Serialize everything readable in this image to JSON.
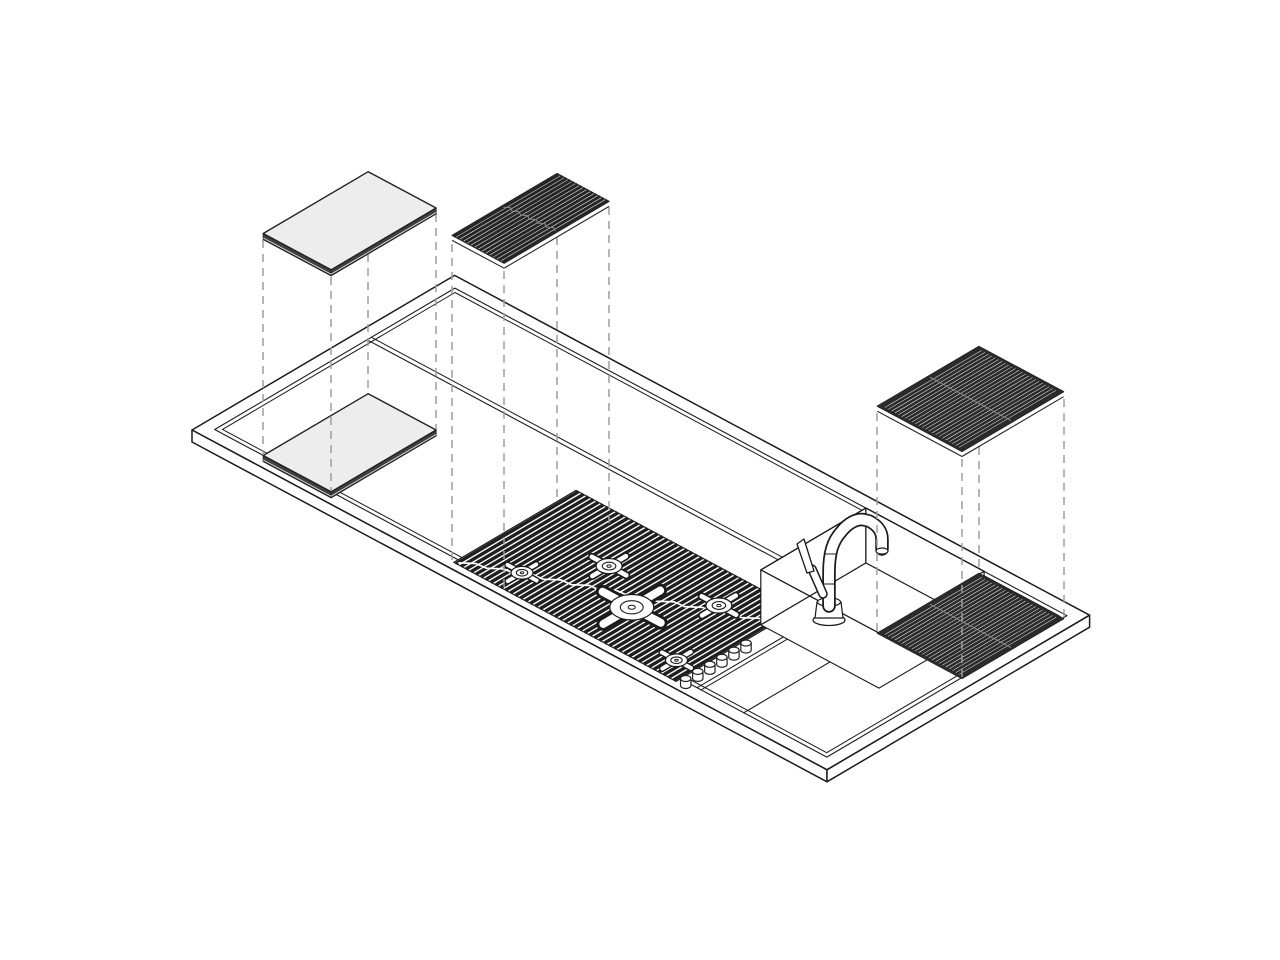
{
  "canvas": {
    "width": 1280,
    "height": 960,
    "background": "#ffffff"
  },
  "iso": {
    "origin": [
      192,
      430
    ],
    "u": [
      0.882,
      0.472
    ],
    "v": [
      0.861,
      -0.507
    ]
  },
  "style": {
    "stroke": "#1b1b1b",
    "dash_color": "#9e9e9e",
    "dash_pattern": "8 6",
    "white": "#ffffff",
    "board_top": "#ededed",
    "board_side": "#3f3f3f",
    "grid_dark": "#2b2b2b",
    "slat_dark": "#1f1f1f",
    "seam_light": "#8a8a8a"
  },
  "components": {
    "worktop": "stainless worktop slab with recessed tray",
    "back_channel": "accessory sliding channel along back edge",
    "cutting_board": "sliding board (resting + floating exploded copy)",
    "cooktop": "slatted grill cooktop with 5 burner supports and 6 control knobs",
    "trivet": "floating slatted grill trivet over cooktop",
    "sink": "recessed sink basin with mixer faucet",
    "drying_grid": "dark slatted drying grid right of sink (resting + floating exploded copy)"
  },
  "elements": [
    {
      "n": "worktop-slab-top",
      "t": "poly",
      "p": [
        [
          0,
          0
        ],
        [
          0,
          305
        ],
        [
          720,
          305
        ],
        [
          720,
          0
        ]
      ],
      "dy": 0,
      "f": "#ffffff",
      "s": "#1b1b1b",
      "w": 1.5
    },
    {
      "n": "worktop-front-face",
      "t": "vwall",
      "p": [
        [
          0,
          0
        ],
        [
          720,
          0
        ]
      ],
      "h": 12,
      "f": "#ffffff",
      "s": "#1b1b1b",
      "w": 1.5
    },
    {
      "n": "worktop-right-face",
      "t": "vwall",
      "p": [
        [
          720,
          0
        ],
        [
          720,
          305
        ]
      ],
      "h": 12,
      "f": "#ffffff",
      "s": "#1b1b1b",
      "w": 1.5
    },
    {
      "n": "tray-rim-outer",
      "t": "poly",
      "p": [
        [
          13,
          13
        ],
        [
          13,
          292
        ],
        [
          707,
          292
        ],
        [
          707,
          13
        ]
      ],
      "dy": 0,
      "f": "none",
      "s": "#1b1b1b",
      "w": 1.1
    },
    {
      "n": "tray-rim-inner",
      "t": "poly",
      "p": [
        [
          17.5,
          17.5
        ],
        [
          17.5,
          287.5
        ],
        [
          702.5,
          287.5
        ],
        [
          702.5,
          17.5
        ]
      ],
      "dy": 0,
      "f": "none",
      "s": "#1b1b1b",
      "w": 1
    },
    {
      "n": "back-channel-line-1",
      "t": "line",
      "p": [
        [
          13,
          190
        ],
        [
          479,
          190
        ]
      ],
      "dy": 0,
      "s": "#1b1b1b",
      "w": 1.1
    },
    {
      "n": "back-channel-line-2",
      "t": "line",
      "p": [
        [
          13,
          195
        ],
        [
          479,
          195
        ]
      ],
      "dy": 0,
      "s": "#1b1b1b",
      "w": 1
    },
    {
      "n": "cooktop-border",
      "t": "poly",
      "p": [
        [
          289,
          8
        ],
        [
          289,
          150
        ],
        [
          541,
          150
        ],
        [
          541,
          8
        ]
      ],
      "dy": 0,
      "f": "#ffffff",
      "s": "#1f1f1f",
      "w": 1.2
    },
    {
      "n": 45,
      "t": "slats",
      "a0": 289,
      "a1": 541,
      "b0": 8,
      "b1": 150,
      "dy": 0,
      "s": "#1f1f1f",
      "w": 3.4
    },
    {
      "n": "cooktop-seam",
      "t": "wavy",
      "a0": 292,
      "a1": 538,
      "b0": 12,
      "b1": 122,
      "amp": 2,
      "seg": 22,
      "dy": 0,
      "s": "#ffffff",
      "w": 1.7
    },
    {
      "n": "burner-1",
      "t": "burner",
      "a": 340,
      "b": 35,
      "r": 11
    },
    {
      "n": "burner-2",
      "t": "burner",
      "a": 385,
      "b": 90,
      "r": 13
    },
    {
      "n": "burner-3",
      "t": "burner",
      "a": 440,
      "b": 60,
      "r": 22
    },
    {
      "n": "burner-4",
      "t": "burner",
      "a": 490,
      "b": 110,
      "r": 13
    },
    {
      "n": "burner-5",
      "t": "burner",
      "a": 520,
      "b": 30,
      "r": 11
    },
    {
      "n": "apron-line-1",
      "t": "line",
      "p": [
        [
          560,
          13
        ],
        [
          560,
          170
        ]
      ],
      "dy": 0,
      "s": "#1b1b1b",
      "w": 1.1
    },
    {
      "n": "apron-line-2",
      "t": "line",
      "p": [
        [
          564.5,
          13
        ],
        [
          564.5,
          170
        ]
      ],
      "dy": 0,
      "s": "#1b1b1b",
      "w": 1
    },
    {
      "n": "section-divider",
      "t": "line",
      "p": [
        [
          613,
          13
        ],
        [
          613,
          170
        ]
      ],
      "dy": 0,
      "s": "#1b1b1b",
      "w": 1.1
    },
    {
      "n": "knob-1",
      "t": "knob",
      "a": 551,
      "b": 9
    },
    {
      "n": "knob-2",
      "t": "knob",
      "a": 551,
      "b": 23
    },
    {
      "n": "knob-3",
      "t": "knob",
      "a": 551,
      "b": 37
    },
    {
      "n": "knob-4",
      "t": "knob",
      "a": 551,
      "b": 51
    },
    {
      "n": "knob-5",
      "t": "knob",
      "a": 551,
      "b": 65
    },
    {
      "n": "knob-6",
      "t": "knob",
      "a": 551,
      "b": 79
    },
    {
      "n": "sink-west-wall",
      "t": "vwall",
      "p": [
        [
          479,
          170
        ],
        [
          479,
          292
        ]
      ],
      "h": 55,
      "f": "#ffffff",
      "s": "#1b1b1b",
      "w": 1.2
    },
    {
      "n": "sink-back-wall",
      "t": "vwall",
      "p": [
        [
          479,
          292
        ],
        [
          613,
          292
        ]
      ],
      "h": 55,
      "f": "#ffffff",
      "s": "#1b1b1b",
      "w": 1.2
    },
    {
      "n": "sink-floor",
      "t": "poly",
      "p": [
        [
          479,
          170
        ],
        [
          479,
          292
        ],
        [
          613,
          292
        ],
        [
          613,
          170
        ]
      ],
      "dy": 55,
      "f": "#ffffff",
      "s": "#1b1b1b",
      "w": 1.1
    },
    {
      "n": "sink-rim",
      "t": "poly",
      "p": [
        [
          479,
          170
        ],
        [
          479,
          292
        ],
        [
          613,
          292
        ],
        [
          613,
          170
        ]
      ],
      "dy": 0,
      "f": "none",
      "s": "#1b1b1b",
      "w": 1.3
    },
    {
      "n": "faucet-base-flange",
      "t": "sellipse",
      "cx": 829,
      "cy": 620,
      "rx": 16,
      "ry": 5.5,
      "f": "#ffffff",
      "s": "#1b1b1b",
      "w": 1.3
    },
    {
      "n": "faucet-base-cup",
      "t": "spath",
      "d": "M817,602 L841,602 L843,618 L815,618 Z",
      "f": "#ffffff",
      "s": "#1b1b1b",
      "w": 1.2
    },
    {
      "n": "faucet-base-top",
      "t": "sellipse",
      "cx": 829,
      "cy": 602,
      "rx": 11.5,
      "ry": 4.2,
      "f": "#ffffff",
      "s": "#1b1b1b",
      "w": 1.2
    },
    {
      "n": "faucet-riser-outline",
      "t": "spath",
      "d": "M829,606 L829,573 C829,552 833,541 841,532 C848,523 857,518 865,520 L869,521 C877,525 882,531 882,539 L882,549",
      "f": "none",
      "s": "#1b1b1b",
      "w": 13.5,
      "cap": "round"
    },
    {
      "n": "faucet-riser-fill",
      "t": "spath",
      "d": "M829,606 L829,573 C829,552 833,541 841,532 C848,523 857,518 865,520 L869,521 C877,525 882,531 882,539 L882,549",
      "f": "none",
      "s": "#ffffff",
      "w": 10,
      "cap": "round"
    },
    {
      "n": "faucet-joint-1",
      "t": "spath",
      "d": "M822.5,584 L835.5,584",
      "f": "none",
      "s": "#1b1b1b",
      "w": 1
    },
    {
      "n": "faucet-joint-2",
      "t": "spath",
      "d": "M824,554 L837,554",
      "f": "none",
      "s": "#1b1b1b",
      "w": 1
    },
    {
      "n": "faucet-spout-tip",
      "t": "sellipse",
      "cx": 882,
      "cy": 551,
      "rx": 6,
      "ry": 3,
      "f": "#ffffff",
      "s": "#1b1b1b",
      "w": 1.2
    },
    {
      "n": "faucet-handle-outline",
      "t": "spath",
      "d": "M823,594 L812,569",
      "f": "none",
      "s": "#1b1b1b",
      "w": 9.5,
      "cap": "round"
    },
    {
      "n": "faucet-handle-fill",
      "t": "spath",
      "d": "M823,594 L812,569",
      "f": "none",
      "s": "#ffffff",
      "w": 6.5,
      "cap": "round"
    },
    {
      "n": "faucet-handle-blade",
      "t": "spath",
      "d": "M814,571 L804,539 L797,544 L807,573 Z",
      "f": "#ffffff",
      "s": "#1b1b1b",
      "w": 1.3
    },
    {
      "n": "resting-board",
      "t": "prism",
      "a0": 68,
      "a1": 145,
      "b0": 13,
      "b1": 135,
      "dy": 0,
      "h": 6,
      "top": "#ededed",
      "side": "#3f3f3f",
      "s": "#222222"
    },
    {
      "n": "resting-drying-grid",
      "t": "grate",
      "a0": 612,
      "a1": 708,
      "b0": 169,
      "b1": 287,
      "dy": 0,
      "rails": 0
    },
    {
      "n": "projection-dash",
      "t": "dash",
      "x": 263,
      "y0": 240,
      "y1": 455
    },
    {
      "n": "projection-dash",
      "t": "dash",
      "x": 331,
      "y0": 277,
      "y1": 491
    },
    {
      "n": "projection-dash",
      "t": "dash",
      "x": 368,
      "y0": 254,
      "y1": 393
    },
    {
      "n": "projection-dash",
      "t": "dash",
      "x": 436,
      "y0": 214,
      "y1": 429
    },
    {
      "n": "projection-dash",
      "t": "dash",
      "x": 452,
      "y0": 244,
      "y1": 563
    },
    {
      "n": "projection-dash",
      "t": "dash",
      "x": 504,
      "y0": 271,
      "y1": 591
    },
    {
      "n": "projection-dash",
      "t": "dash",
      "x": 557,
      "y0": 237,
      "y1": 501
    },
    {
      "n": "projection-dash",
      "t": "dash",
      "x": 609,
      "y0": 207,
      "y1": 529
    },
    {
      "n": "projection-dash",
      "t": "dash",
      "x": 877,
      "y0": 413,
      "y1": 632
    },
    {
      "n": "projection-dash",
      "t": "dash",
      "x": 962,
      "y0": 459,
      "y1": 678
    },
    {
      "n": "projection-dash",
      "t": "dash",
      "x": 979,
      "y0": 447,
      "y1": 573
    },
    {
      "n": "projection-dash",
      "t": "dash",
      "x": 1064,
      "y0": 399,
      "y1": 618
    },
    {
      "n": "floating-board",
      "t": "prism",
      "a0": 68,
      "a1": 145,
      "b0": 13,
      "b1": 135,
      "dy": -222,
      "h": 6,
      "top": "#ededed",
      "side": "#3f3f3f",
      "s": "#222222"
    },
    {
      "n": "floating-trivet-base",
      "t": "poly",
      "p": [
        [
          289,
          6
        ],
        [
          289,
          128
        ],
        [
          348,
          128
        ],
        [
          348,
          6
        ]
      ],
      "dy": -328,
      "f": "#ffffff",
      "s": "#262626",
      "w": 1.2
    },
    {
      "n": 14,
      "t": "slats",
      "a0": 289,
      "a1": 348,
      "b0": 6,
      "b1": 128,
      "dy": -328,
      "s": "#262626",
      "w": 3.1
    },
    {
      "n": "floating-trivet-seam",
      "t": "wavy",
      "a0": 291,
      "a1": 346,
      "b0": 65,
      "b1": 69,
      "amp": 1.5,
      "seg": 12,
      "dy": -328,
      "s": "#8a8a8a",
      "w": 1
    },
    {
      "n": "floating-trivet-rail-front",
      "t": "line",
      "p": [
        [
          289,
          6
        ],
        [
          348,
          6
        ]
      ],
      "dy": -323,
      "s": "#262626",
      "w": 1.1
    },
    {
      "n": "floating-trivet-rail-right",
      "t": "line",
      "p": [
        [
          348,
          6
        ],
        [
          348,
          128
        ]
      ],
      "dy": -323,
      "s": "#262626",
      "w": 1.1
    },
    {
      "n": "floating-drying-grid",
      "t": "grate",
      "a0": 612,
      "a1": 708,
      "b0": 169,
      "b1": 287,
      "dy": -227,
      "rails": 5
    }
  ]
}
